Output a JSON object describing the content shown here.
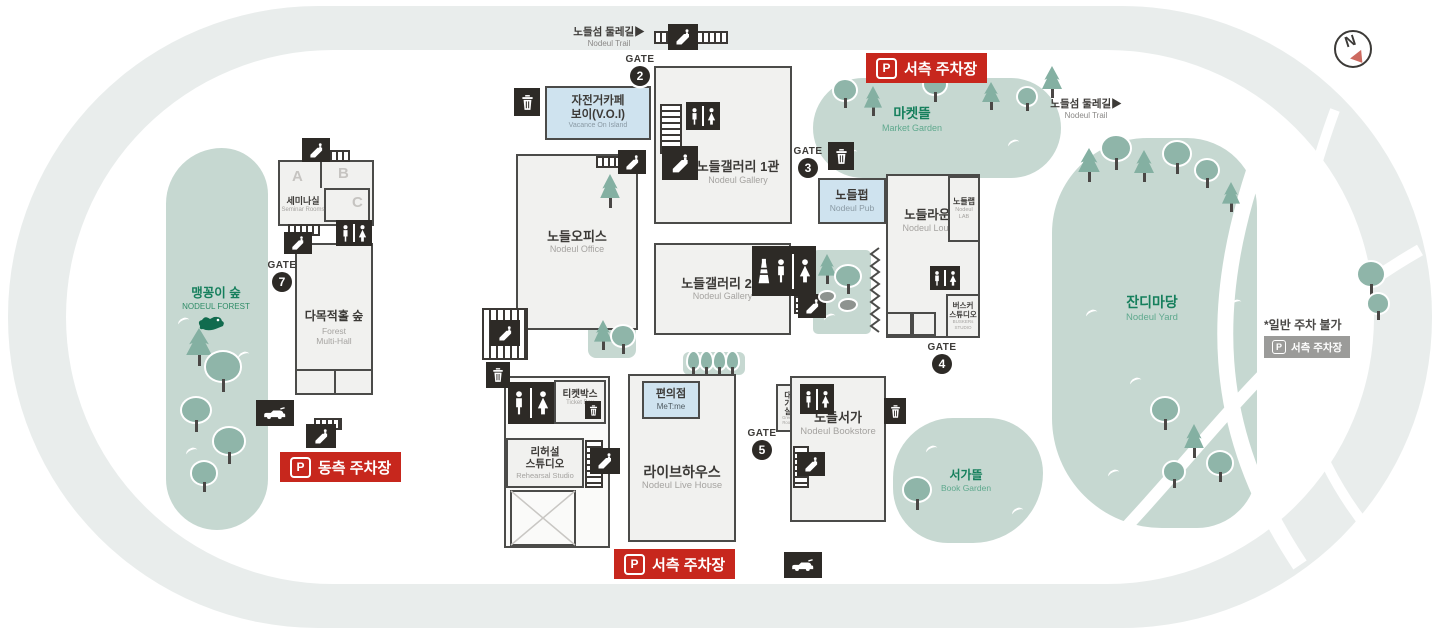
{
  "colors": {
    "island_ring": "#e9edec",
    "green_area": "#c6d8d1",
    "tree": "#8fb5a9",
    "building_fill": "#f1f1ef",
    "outline": "#4b4b49",
    "icon_black": "#2d2a26",
    "accent_red": "#c7271d",
    "highlight_blue": "#cfe3ef",
    "label_green": "#157f5c",
    "badge_gray": "#9b9b99"
  },
  "compass": {
    "label": "N"
  },
  "trails": {
    "top_kr": "노들섬 둘레길▶",
    "top_en": "Nodeul Trail",
    "right_kr": "노들섬 둘레길▶",
    "right_en": "Nodeul Trail"
  },
  "gates": {
    "label": "GATE",
    "g2": "2",
    "g3": "3",
    "g4": "4",
    "g5": "5",
    "g7": "7"
  },
  "parking": {
    "p": "P",
    "west_top": "서측 주차장",
    "west_bottom": "서측 주차장",
    "east": "동측 주차장",
    "gray_west": "서측 주차장",
    "note": "*일반 주차 불가"
  },
  "areas": {
    "forest": {
      "kr": "맹꽁이 숲",
      "en": "NODEUL FOREST"
    },
    "market": {
      "kr": "마켓뜰",
      "en": "Market Garden"
    },
    "yard": {
      "kr": "잔디마당",
      "en": "Nodeul Yard"
    },
    "book_garden": {
      "kr": "서가뜰",
      "en": "Book Garden"
    }
  },
  "buildings": {
    "bike_cafe": {
      "kr1": "자전거카페",
      "kr2": "보이(V.O.I)",
      "en": "Vacance On Island"
    },
    "gallery1": {
      "kr": "노들갤러리 1관",
      "en": "Nodeul Gallery"
    },
    "gallery2": {
      "kr": "노들갤러리 2관",
      "en": "Nodeul Gallery"
    },
    "office": {
      "kr": "노들오피스",
      "en": "Nodeul Office"
    },
    "seminar": {
      "kr": "세미나실",
      "en": "Seminar Rooms",
      "rooms": [
        "A",
        "B",
        "C"
      ]
    },
    "multi_hall": {
      "kr": "다목적홀 숲",
      "en1": "Forest",
      "en2": "Multi-Hall"
    },
    "pub": {
      "kr": "노들펍",
      "en": "Nodeul Pub"
    },
    "lounge": {
      "kr": "노들라운지",
      "en": "Nodeul Lounge"
    },
    "lab": {
      "kr": "노들랩",
      "en1": "Nodeul",
      "en2": "LAB"
    },
    "busker_studio": {
      "kr1": "버스커",
      "kr2": "스튜디오",
      "en1": "BUSKERs",
      "en2": "STUDIO"
    },
    "ticket_box": {
      "kr": "티켓박스",
      "en": "Ticket Box"
    },
    "convenience": {
      "kr": "편의점",
      "en": "MeT:me"
    },
    "rehearsal": {
      "kr1": "리허설",
      "kr2": "스튜디오",
      "en": "Rehearsal Studio"
    },
    "live_house": {
      "kr": "라이브하우스",
      "en": "Nodeul Live House"
    },
    "bookstore": {
      "kr": "노들서가",
      "en": "Nodeul Bookstore"
    },
    "green_room": {
      "kr": "대기실",
      "en1": "Green",
      "en2": "Room"
    }
  },
  "icons": {
    "restroom": "man-woman-figures",
    "trash": "waste-bin",
    "stairs": "step-rungs",
    "escalator": "diagonal-steps-person",
    "car": "car-side",
    "crosswalk": "striped-path",
    "frog": "frog",
    "zigzag_wall": "accordion-wall",
    "compass": "north-needle",
    "parking_p": "P",
    "nursing": "bottle-tower"
  }
}
